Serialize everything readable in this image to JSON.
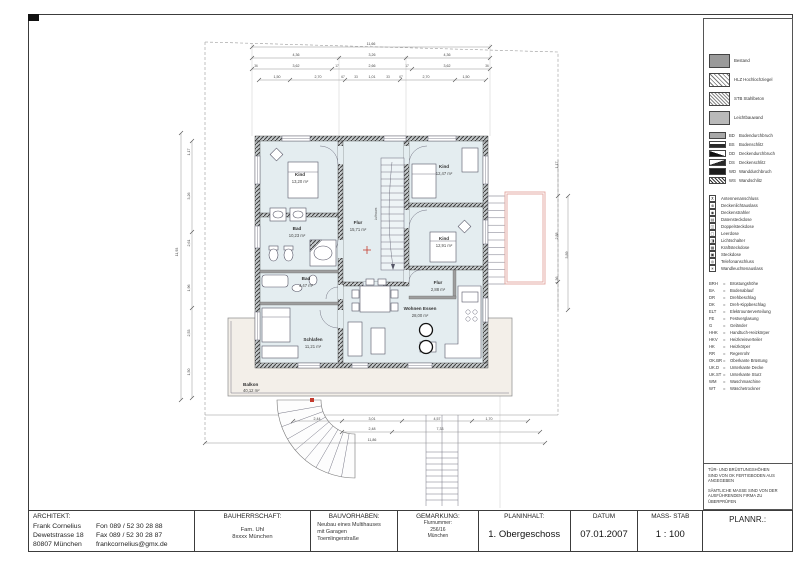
{
  "title_block": {
    "architect": {
      "header": "ARCHITEKT:",
      "name": "Frank Cornelius",
      "street": "Dewetstrasse 18",
      "city": "80807 München",
      "fon": "Fon   089 / 52 30 28 88",
      "fax": "Fax   089 / 52 30 28 87",
      "email": "frankcornelius@gmx.de"
    },
    "client": {
      "header": "BAUHERRSCHAFT:",
      "line1": "Fam. Uhl",
      "line2": "8xxxx München"
    },
    "project": {
      "header": "BAUVORHABEN:",
      "line1": "Neubau eines Multihauses",
      "line2": "mit Garagen",
      "line3": "Toemlingerstraße"
    },
    "district": {
      "header": "GEMARKUNG:",
      "line1": "Flurnummer:",
      "line2": "256/16",
      "line3": "München"
    },
    "content": {
      "header": "PLANINHALT:",
      "value": "1. Obergeschoss"
    },
    "date": {
      "header": "DATUM",
      "value": "07.01.2007"
    },
    "scale": {
      "header": "MASS- STAB",
      "value": "1 : 100"
    },
    "plan_no": {
      "header": "PLANNR.:"
    }
  },
  "legend": {
    "materials": [
      {
        "label": "Bestand",
        "type": "bestand"
      },
      {
        "label": "HLZ Hochlochziegel",
        "type": "hlz"
      },
      {
        "label": "STB Stahlbeton",
        "type": "stb"
      },
      {
        "label": "Leichtbauwand",
        "type": "leicht"
      }
    ],
    "openings": [
      {
        "code": "BD",
        "label": "Bodendurchbruch",
        "type": "bd"
      },
      {
        "code": "BS",
        "label": "Bodenschlitz",
        "type": "bs"
      },
      {
        "code": "DD",
        "label": "Deckendurchbruch",
        "type": "dd"
      },
      {
        "code": "DS",
        "label": "Deckenschlitz",
        "type": "ds"
      },
      {
        "code": "WD",
        "label": "Wanddurchbruch",
        "type": "wd"
      },
      {
        "code": "WS",
        "label": "Wandschlitz",
        "type": "ws"
      }
    ],
    "electrical": [
      {
        "label": "Antennenanschluss",
        "icon": "antenna-icon",
        "glyph": "⊼"
      },
      {
        "label": "Deckenlichtauslass",
        "icon": "ceiling-light-icon",
        "glyph": "⊗"
      },
      {
        "label": "Deckenstrahler",
        "icon": "ceiling-spot-icon",
        "glyph": "◉"
      },
      {
        "label": "Datensteckdose",
        "icon": "data-socket-icon",
        "glyph": "▤"
      },
      {
        "label": "Doppelsteckdose",
        "icon": "double-socket-icon",
        "glyph": "◫"
      },
      {
        "label": "Leerdose",
        "icon": "empty-box-icon",
        "glyph": "▢"
      },
      {
        "label": "Lichtschalter",
        "icon": "light-switch-icon",
        "glyph": "◨"
      },
      {
        "label": "Kraftsteckdose",
        "icon": "power-socket-icon",
        "glyph": "▦"
      },
      {
        "label": "Steckdose",
        "icon": "socket-icon",
        "glyph": "▣"
      },
      {
        "label": "Telefonanschluss",
        "icon": "phone-socket-icon",
        "glyph": "◎"
      },
      {
        "label": "Wandleuchtenauslass",
        "icon": "wall-light-icon",
        "glyph": "✳"
      }
    ],
    "abbreviations": [
      {
        "abbr": "BRH",
        "eq": "=",
        "term": "Brüstungshöhe"
      },
      {
        "abbr": "BA",
        "eq": "=",
        "term": "Bodenablauf"
      },
      {
        "abbr": "DR",
        "eq": "=",
        "term": "Drehbeschlag"
      },
      {
        "abbr": "DK",
        "eq": "=",
        "term": "Dreh-Kippbeschlag"
      },
      {
        "abbr": "ELT",
        "eq": "=",
        "term": "Elektrounterverteilung"
      },
      {
        "abbr": "FE",
        "eq": "=",
        "term": "Festverglasung"
      },
      {
        "abbr": "G",
        "eq": "=",
        "term": "Geländer"
      },
      {
        "abbr": "HHK",
        "eq": "=",
        "term": "Handtuch-Heizkörper"
      },
      {
        "abbr": "HKV",
        "eq": "=",
        "term": "Heizkreisverteiler"
      },
      {
        "abbr": "HK",
        "eq": "=",
        "term": "Heizkörper"
      },
      {
        "abbr": "RR",
        "eq": "=",
        "term": "Regenrohr"
      },
      {
        "abbr": "OK.BR",
        "eq": "=",
        "term": "Oberkante Brüstung"
      },
      {
        "abbr": "UK.D",
        "eq": "=",
        "term": "Unterkante Decke"
      },
      {
        "abbr": "UK.ST",
        "eq": "=",
        "term": "Unterkante Sturz"
      },
      {
        "abbr": "WM",
        "eq": "=",
        "term": "Waschmaschine"
      },
      {
        "abbr": "WT",
        "eq": "=",
        "term": "Wäschetrockner"
      }
    ],
    "notes": [
      "Tür- und Brüstungshöhen sind von OK Fertigboden aus angegeben",
      "Sämtliche Masse sind von der ausführenden Firma zu überprüfen"
    ]
  },
  "plan": {
    "rooms": [
      {
        "name": "Kind",
        "area": "13,20 m²"
      },
      {
        "name": "Flur",
        "area": "15,71 m²"
      },
      {
        "name": "Kind",
        "area": "12,47 m²"
      },
      {
        "name": "Bad",
        "area": "10,23 m²"
      },
      {
        "name": "Kind",
        "area": "12,91 m²"
      },
      {
        "name": "Bad",
        "area": "4,47 m²"
      },
      {
        "name": "Schlafen",
        "area": "11,21 m²"
      },
      {
        "name": "Wohnen Essen",
        "area": "28,00 m²"
      },
      {
        "name": "Flur",
        "area": "2,88 m²"
      },
      {
        "name": "Balkon",
        "area": "40,12 m²"
      }
    ],
    "stair_void_label": "Luftraum",
    "colors": {
      "room_fill": "#e4edf0",
      "balcony_fill": "#f3efe9",
      "wall_hatch": "#3e3e3e",
      "accent_red": "#c43b2e",
      "accent_pink": "#e2a69e"
    },
    "dim_labels": [
      {
        "t": "11,66",
        "x": 371,
        "y": 45
      },
      {
        "t": "4,36",
        "x": 296,
        "y": 56
      },
      {
        "t": "3,26",
        "x": 372,
        "y": 56
      },
      {
        "t": "4,36",
        "x": 447,
        "y": 56
      },
      {
        "t": "36",
        "x": 256,
        "y": 67
      },
      {
        "t": "3,62",
        "x": 296,
        "y": 67
      },
      {
        "t": "17",
        "x": 337,
        "y": 67
      },
      {
        "t": "2,66",
        "x": 372,
        "y": 67
      },
      {
        "t": "17",
        "x": 407,
        "y": 67
      },
      {
        "t": "3,62",
        "x": 447,
        "y": 67
      },
      {
        "t": "36",
        "x": 487,
        "y": 67
      },
      {
        "t": "1,50",
        "x": 277,
        "y": 78
      },
      {
        "t": "2,70",
        "x": 318,
        "y": 78
      },
      {
        "t": "67",
        "x": 343,
        "y": 78
      },
      {
        "t": "33",
        "x": 356,
        "y": 78
      },
      {
        "t": "1,01",
        "x": 372,
        "y": 78
      },
      {
        "t": "33",
        "x": 388,
        "y": 78
      },
      {
        "t": "67",
        "x": 401,
        "y": 78
      },
      {
        "t": "2,70",
        "x": 426,
        "y": 78
      },
      {
        "t": "1,50",
        "x": 466,
        "y": 78
      },
      {
        "t": "2,44",
        "x": 317,
        "y": 420
      },
      {
        "t": "3,01",
        "x": 372,
        "y": 420
      },
      {
        "t": "4,57",
        "x": 437,
        "y": 420
      },
      {
        "t": "1,70",
        "x": 489,
        "y": 420
      },
      {
        "t": "2,48",
        "x": 372,
        "y": 430
      },
      {
        "t": "7,33",
        "x": 440,
        "y": 430
      },
      {
        "t": "11,86",
        "x": 372,
        "y": 441
      },
      {
        "t": "11,93",
        "x": 178,
        "y": 252,
        "r": -90
      },
      {
        "t": "1,17",
        "x": 190,
        "y": 152,
        "r": -90
      },
      {
        "t": "3,26",
        "x": 190,
        "y": 196,
        "r": -90
      },
      {
        "t": "2,61",
        "x": 190,
        "y": 243,
        "r": -90
      },
      {
        "t": "1,96",
        "x": 190,
        "y": 288,
        "r": -90
      },
      {
        "t": "2,53",
        "x": 190,
        "y": 333,
        "r": -90
      },
      {
        "t": "1,50",
        "x": 190,
        "y": 372,
        "r": -90
      },
      {
        "t": "1,17",
        "x": 558,
        "y": 165,
        "r": -90
      },
      {
        "t": "2,88",
        "x": 558,
        "y": 236,
        "r": -90
      },
      {
        "t": "1,36",
        "x": 558,
        "y": 280,
        "r": -90
      },
      {
        "t": "3,89",
        "x": 568,
        "y": 255,
        "r": -90
      }
    ]
  }
}
